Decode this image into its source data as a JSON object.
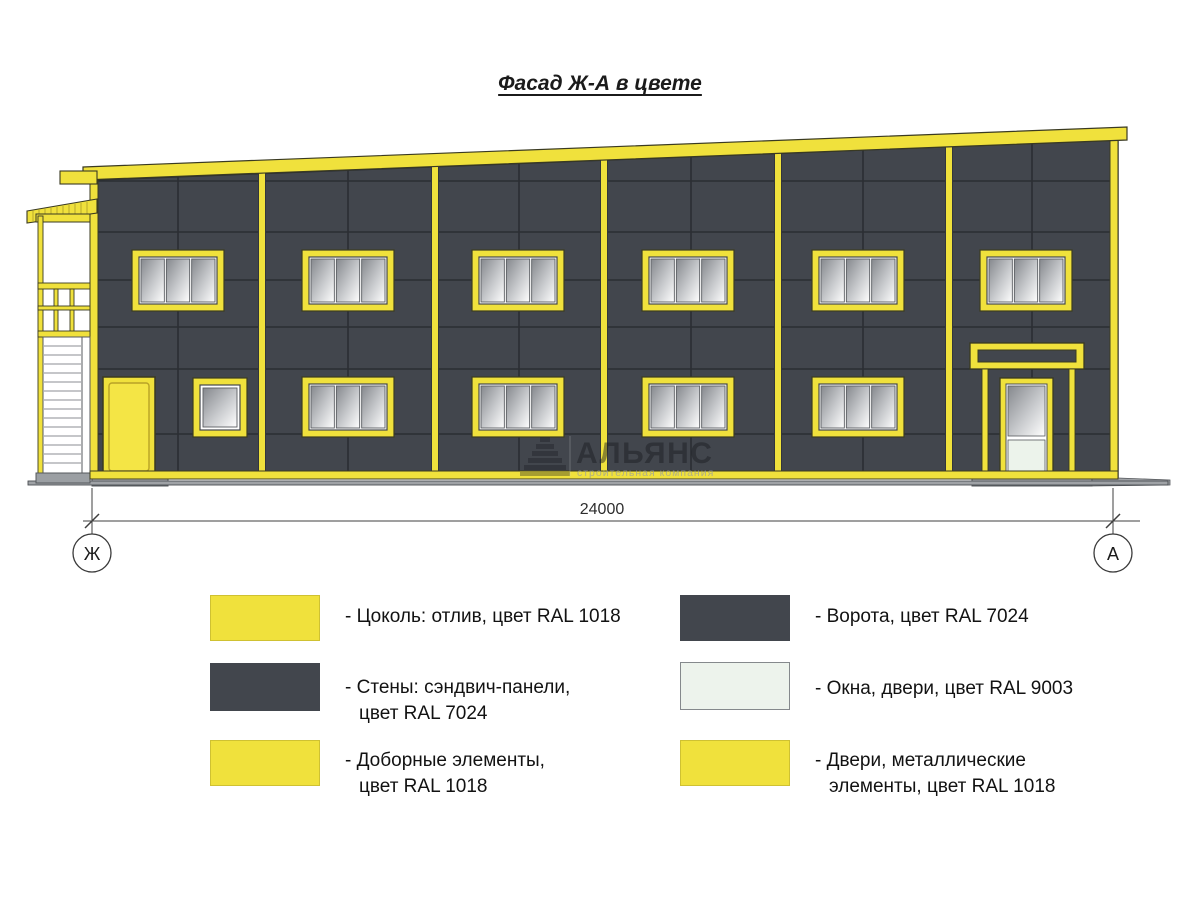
{
  "title": "Фасад Ж-А в цвете",
  "dimension": {
    "value": "24000",
    "axis_left": "Ж",
    "axis_right": "А"
  },
  "watermark": {
    "name": "АЛЬЯНС",
    "subtitle": "строительная компания"
  },
  "legend": {
    "items": [
      {
        "swatch": "yellow",
        "label_line1": "- Цоколь: отлив, цвет RAL 1018",
        "label_line2": ""
      },
      {
        "swatch": "dark",
        "label_line1": "- Стены: сэндвич-панели,",
        "label_line2": "цвет RAL 7024"
      },
      {
        "swatch": "yellow",
        "label_line1": "- Доборные элементы,",
        "label_line2": "цвет RAL 1018"
      },
      {
        "swatch": "dark",
        "label_line1": "- Ворота, цвет RAL 7024",
        "label_line2": ""
      },
      {
        "swatch": "light",
        "label_line1": "- Окна, двери, цвет RAL 9003",
        "label_line2": ""
      },
      {
        "swatch": "yellow",
        "label_line1": "- Двери, металлические",
        "label_line2": "элементы, цвет RAL 1018"
      }
    ]
  },
  "colors": {
    "ral_1018_yellow": "#F0E13C",
    "ral_7024_grey": "#42464D",
    "ral_9003_white": "#EDF3EC",
    "panel_joint": "#2B2E33",
    "glass_grey": "#8F9297",
    "ground_grey": "#9FA2A6",
    "line_dark": "#3A3A22"
  },
  "facade": {
    "floor2_windows": {
      "y": 250,
      "w": 92,
      "h": 61,
      "panes": 3,
      "x": [
        132,
        302,
        472,
        642,
        812,
        980
      ]
    },
    "floor1_windows": {
      "y": 377,
      "w": 92,
      "h": 60,
      "panes": 3,
      "x": [
        302,
        472,
        642,
        812
      ]
    },
    "mullion_x": [
      262,
      435,
      604,
      778,
      949
    ],
    "joint_y": [
      181,
      232,
      280,
      327,
      369,
      434
    ],
    "joint_x": [
      178,
      348,
      519,
      691,
      863,
      1032
    ]
  }
}
